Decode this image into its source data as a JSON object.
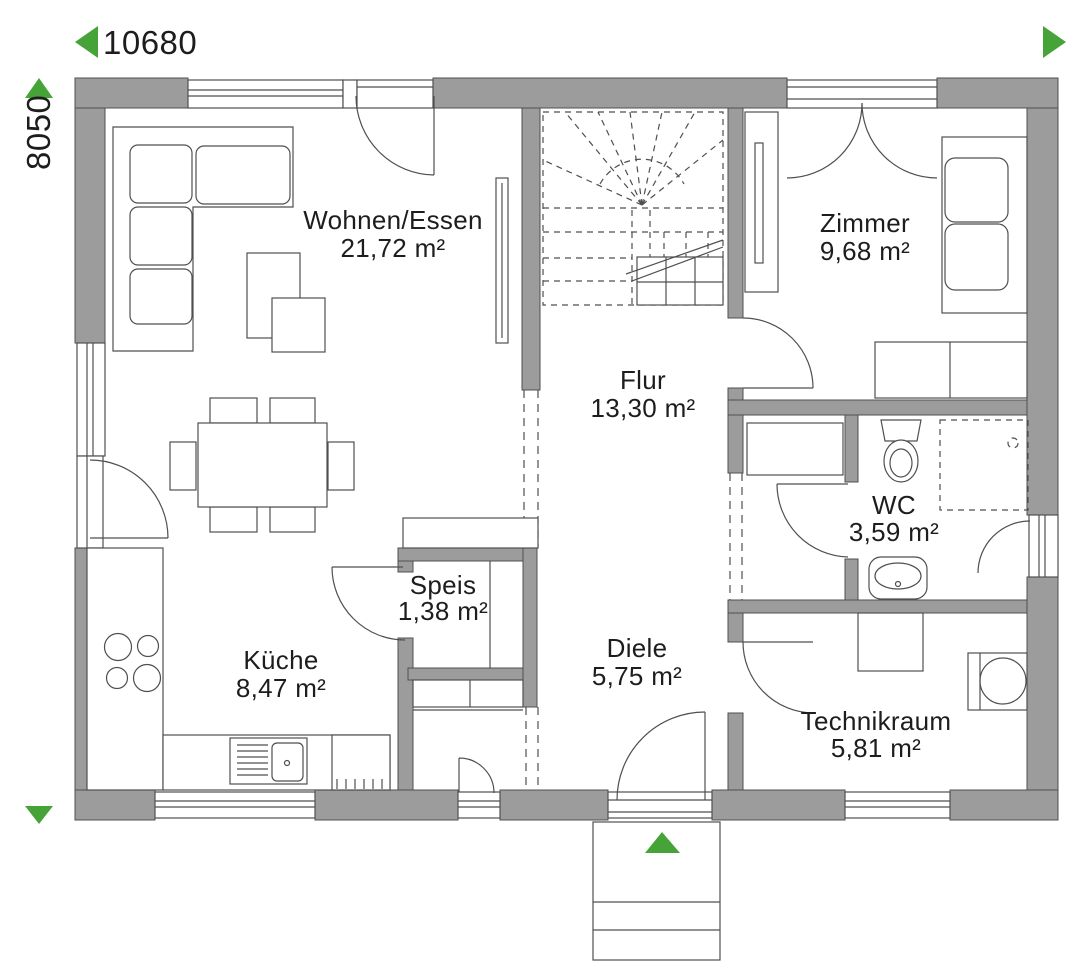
{
  "dimensions": {
    "horizontal": "10680",
    "vertical": "8050"
  },
  "rooms": [
    {
      "id": "wohnen",
      "name": "Wohnen/Essen",
      "area": "21,72 m²"
    },
    {
      "id": "zimmer",
      "name": "Zimmer",
      "area": "9,68 m²"
    },
    {
      "id": "flur",
      "name": "Flur",
      "area": "13,30 m²"
    },
    {
      "id": "wc",
      "name": "WC",
      "area": "3,59 m²"
    },
    {
      "id": "speis",
      "name": "Speis",
      "area": "1,38 m²"
    },
    {
      "id": "kueche",
      "name": "Küche",
      "area": "8,47 m²"
    },
    {
      "id": "diele",
      "name": "Diele",
      "area": "5,75 m²"
    },
    {
      "id": "technikraum",
      "name": "Technikraum",
      "area": "5,81 m²"
    }
  ],
  "colors": {
    "wall": "#9C9C9C",
    "line": "#4F4F4F",
    "accent_green": "#46A337",
    "text": "#1D1D1D",
    "background": "#FFFFFF"
  }
}
